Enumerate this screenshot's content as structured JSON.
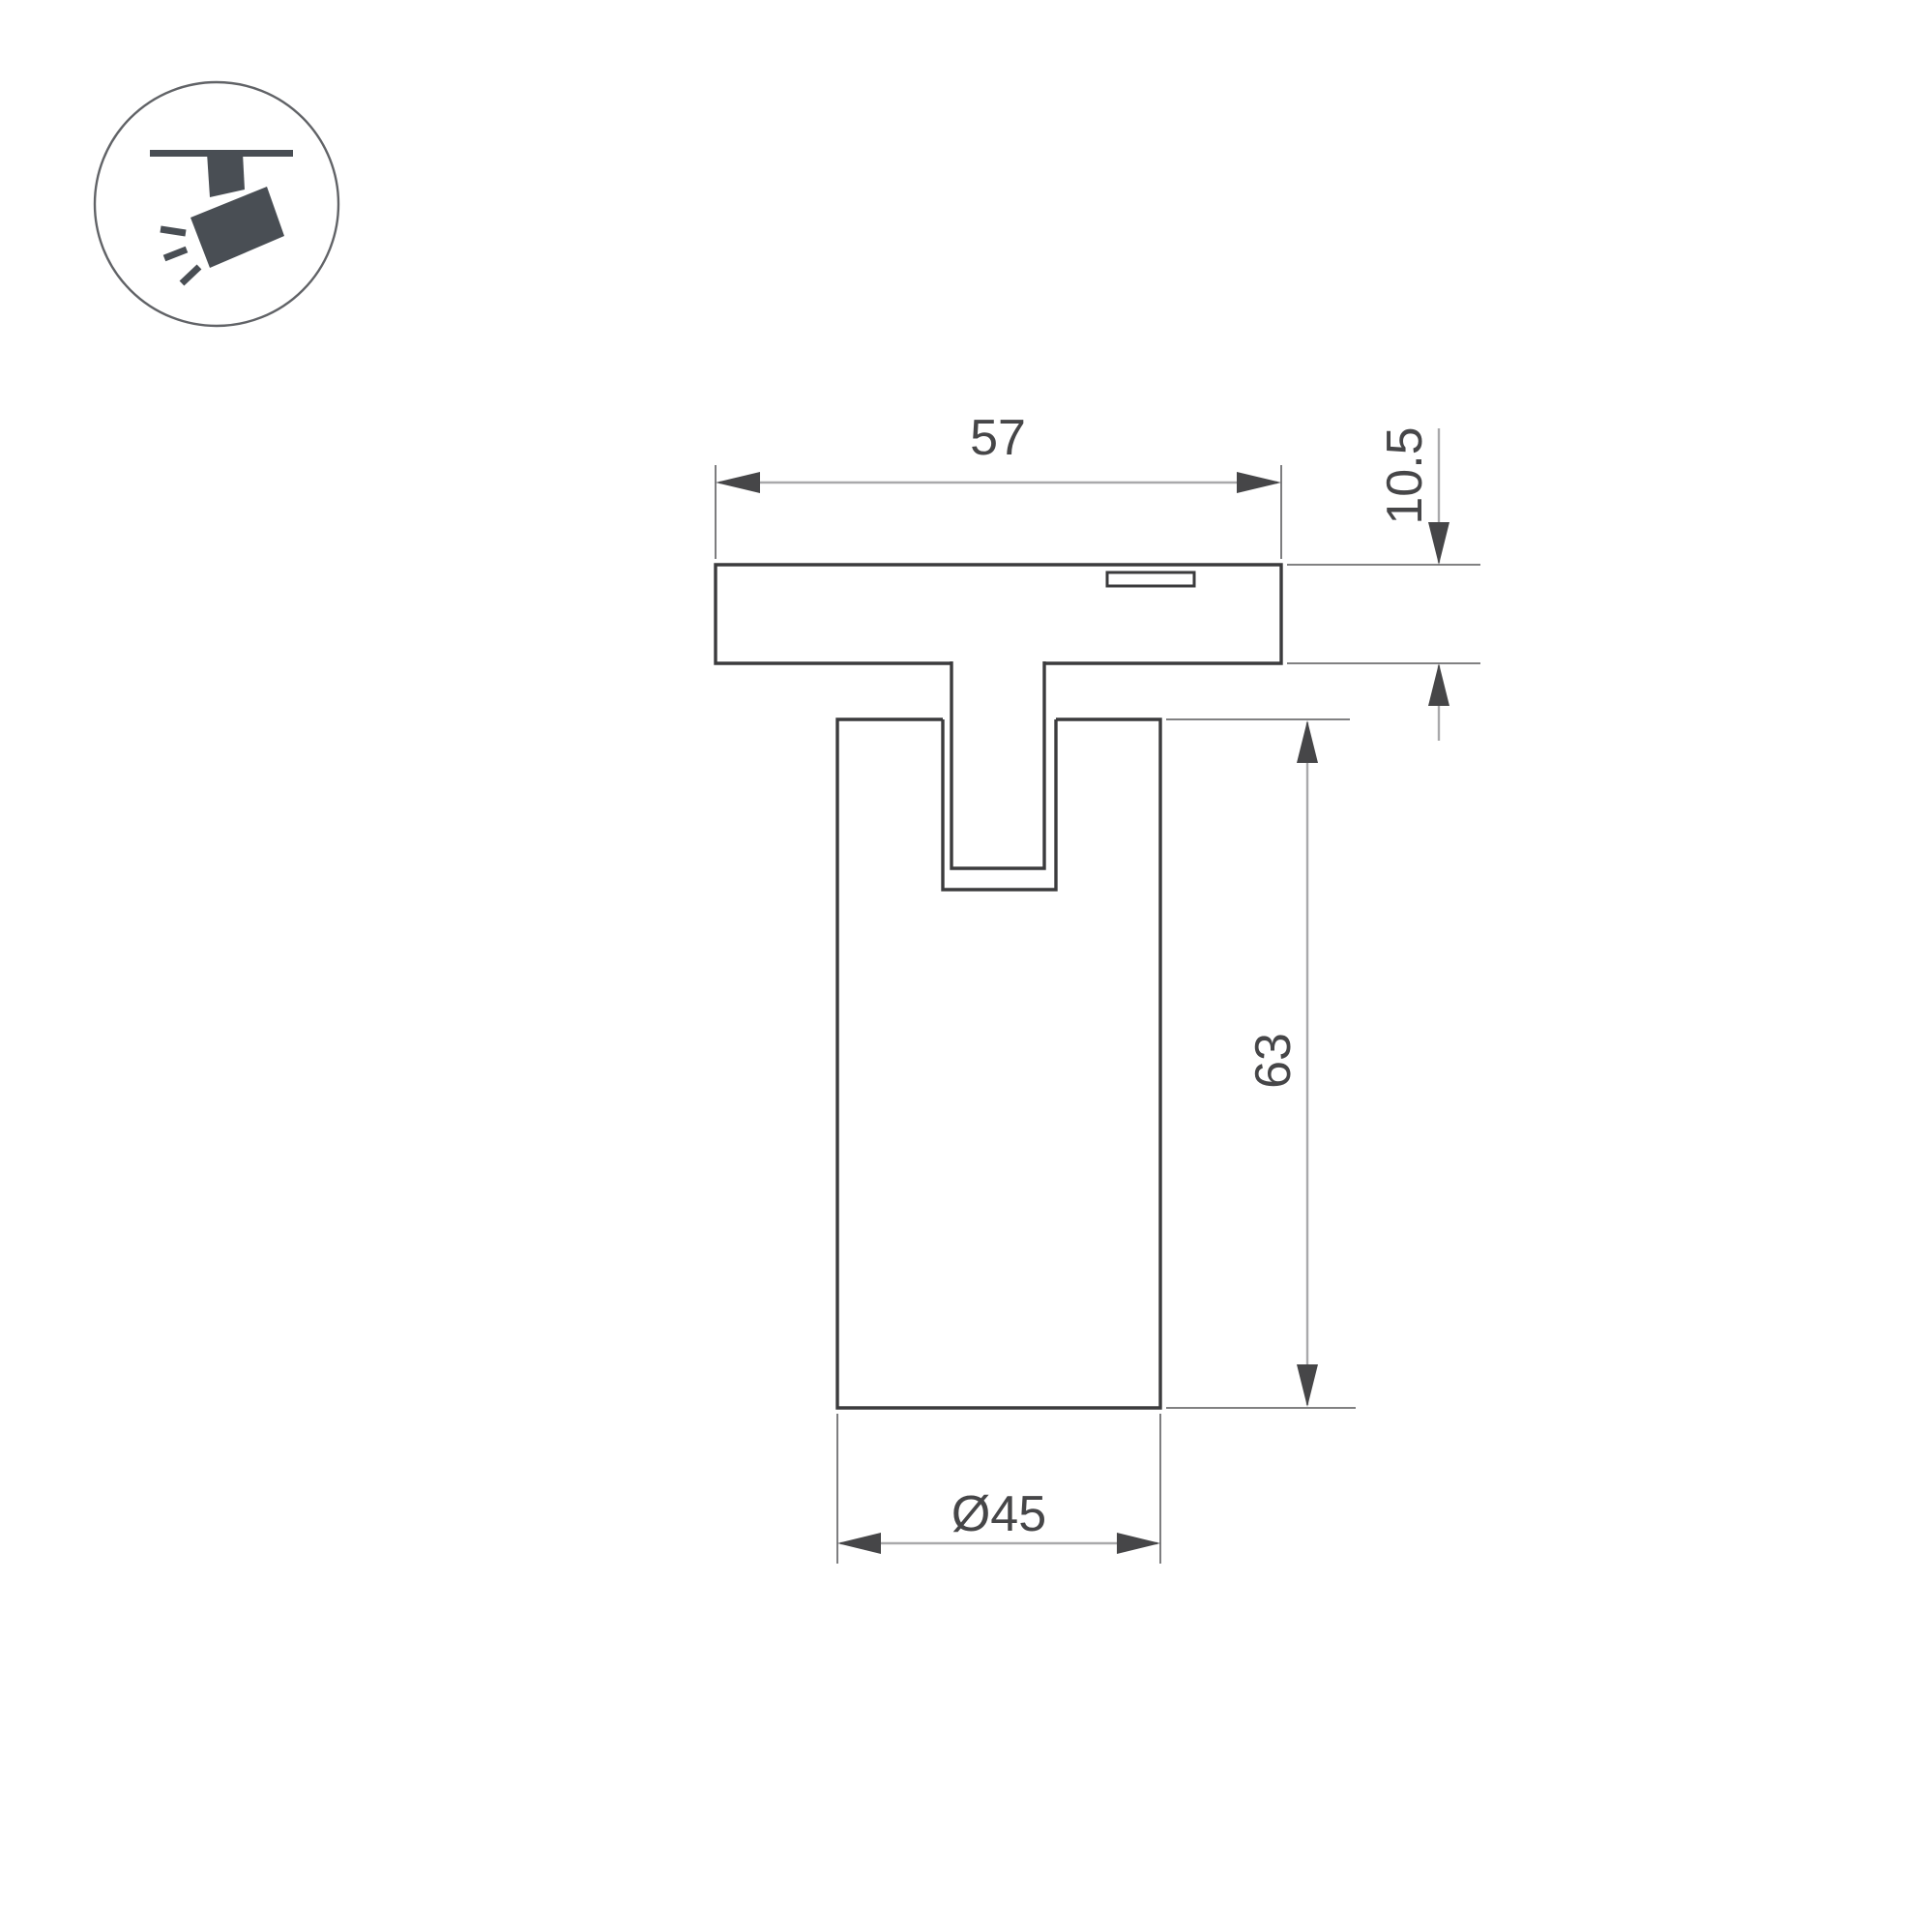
{
  "colors": {
    "background": "#ffffff",
    "outline": "#3b3b3d",
    "dim-line": "#a9a9ab",
    "ext-line": "#6f6f71",
    "accent": "#464648",
    "icon-glyph": "#494e54",
    "icon-ring": "#616367"
  },
  "icon": {
    "name": "track-spotlight-icon"
  },
  "dims": {
    "adapter_width": {
      "label": "57"
    },
    "adapter_thickness": {
      "label": "10.5"
    },
    "body_height": {
      "label": "63"
    },
    "body_diameter": {
      "label": "Ø45"
    }
  }
}
